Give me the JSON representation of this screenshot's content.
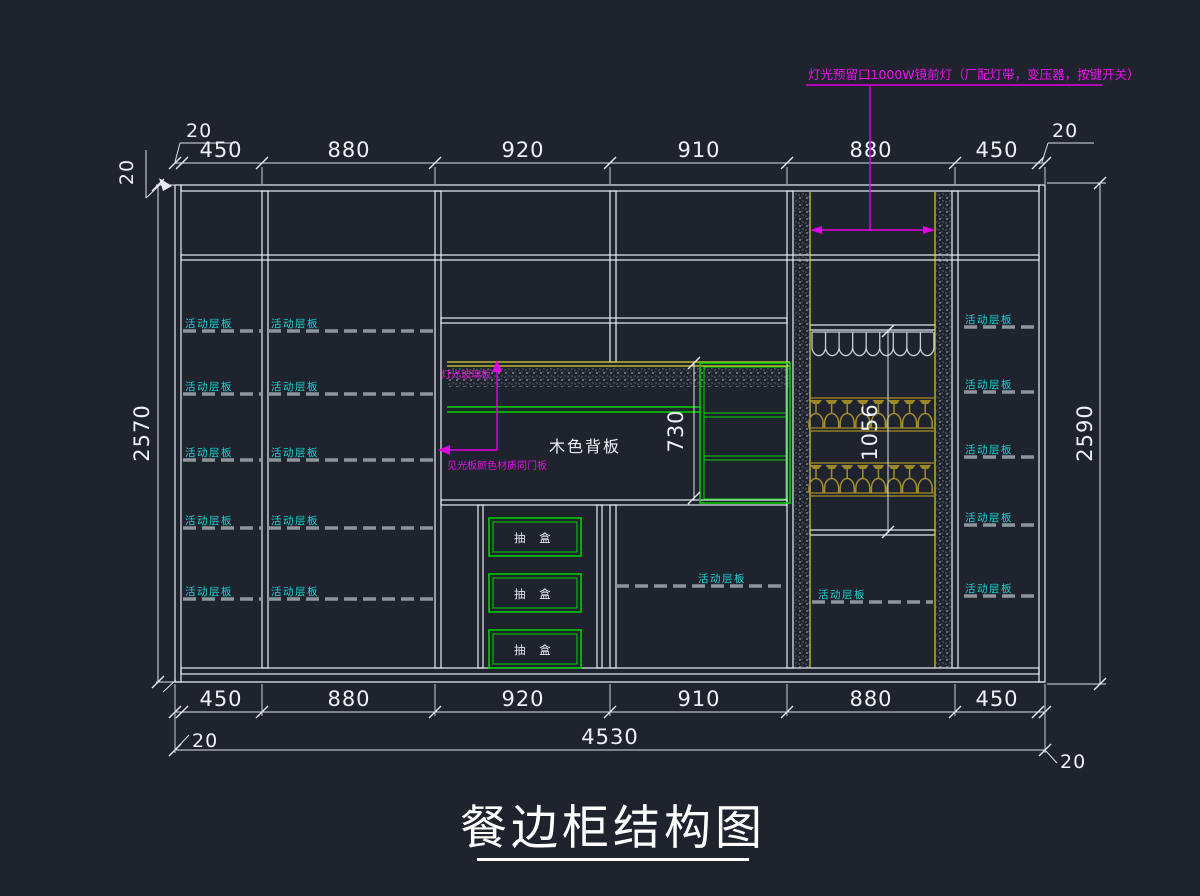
{
  "title": {
    "text": "餐边柜结构图"
  },
  "annotations": {
    "top_note": "灯光预留口1000W镜前灯（厂配灯带，变压器，按键开关）",
    "glass_note": "灯光玻璃板",
    "material_note": "见光板颜色材质同门板",
    "back_panel_label": "木色背板",
    "drawer_label": "抽 盒",
    "shelf_label": "活动层板"
  },
  "dimensions": {
    "top": [
      "450",
      "880",
      "920",
      "910",
      "880",
      "450"
    ],
    "bottom": [
      "450",
      "880",
      "920",
      "910",
      "880",
      "450"
    ],
    "total_width": "4530",
    "left_height": "2570",
    "right_height": "2590",
    "niche_height": "730",
    "wine_section_height": "1056",
    "panel_offset": "20"
  },
  "colors": {
    "background": "#1e232d",
    "line": "#e9edf2",
    "shelf_text": "#17d3d3",
    "green": "#00d800",
    "magenta": "#e400e4",
    "yellow": "#d6d630",
    "gold": "#9d8728"
  }
}
